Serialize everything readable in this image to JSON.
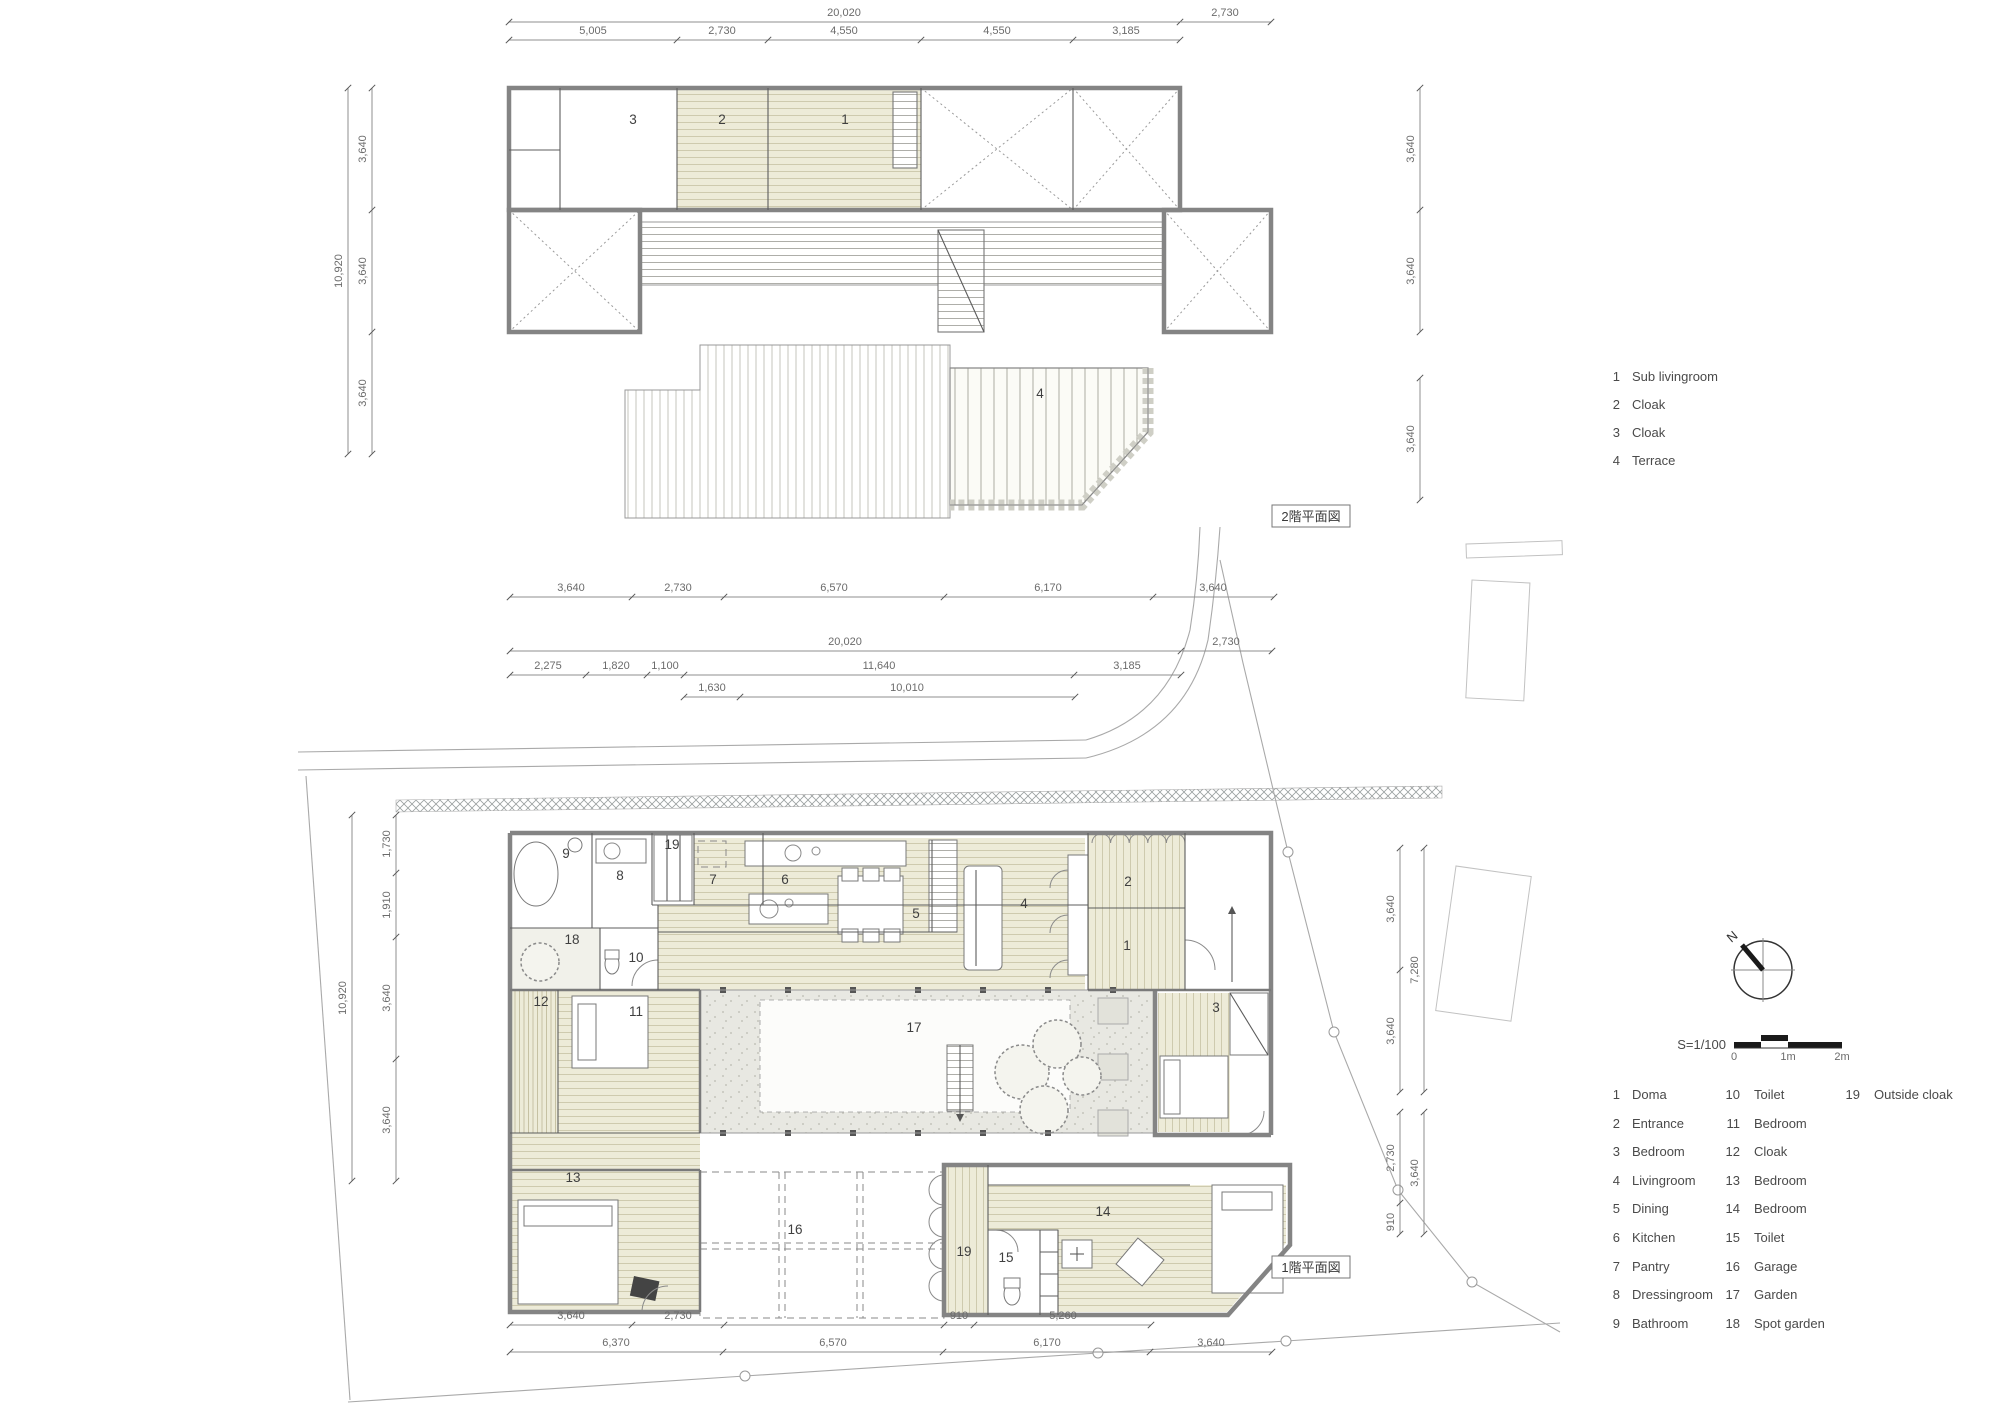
{
  "floor2": {
    "plan_label": "2階平面図",
    "dims": {
      "top_overall": "20,020",
      "top_right": "2,730",
      "top_segments": [
        "5,005",
        "2,730",
        "4,550",
        "4,550",
        "3,185"
      ],
      "left_overall": "10,920",
      "left_segments": [
        "3,640",
        "3,640",
        "3,640"
      ],
      "right_segments": [
        "3,640",
        "3,640"
      ],
      "right_lower": "3,640",
      "bottom_segments": [
        "3,640",
        "2,730",
        "6,570",
        "6,170",
        "3,640"
      ]
    },
    "rooms": [
      {
        "num": "1",
        "name": "Sub livingroom"
      },
      {
        "num": "2",
        "name": "Cloak"
      },
      {
        "num": "3",
        "name": "Cloak"
      },
      {
        "num": "4",
        "name": "Terrace"
      }
    ]
  },
  "floor1": {
    "plan_label": "1階平面図",
    "dims": {
      "top_overall": "20,020",
      "top_right": "2,730",
      "top_row2": [
        "2,275",
        "1,820",
        "1,100",
        "11,640",
        "3,185"
      ],
      "top_row3": [
        "1,630",
        "10,010"
      ],
      "left_overall": "10,920",
      "left_segments": [
        "1,730",
        "1,910",
        "3,640",
        "3,640"
      ],
      "right_upper_overall": "7,280",
      "right_upper_segments": [
        "3,640",
        "3,640"
      ],
      "right_lower_overall": "3,640",
      "right_lower_segments": [
        "2,730",
        "910"
      ],
      "bottom_row1": [
        "3,640",
        "2,730",
        "910",
        "5,260"
      ],
      "bottom_row2": [
        "6,370",
        "6,570",
        "6,170",
        "3,640"
      ]
    },
    "rooms": [
      {
        "num": "1",
        "name": "Doma"
      },
      {
        "num": "2",
        "name": "Entrance"
      },
      {
        "num": "3",
        "name": "Bedroom"
      },
      {
        "num": "4",
        "name": "Livingroom"
      },
      {
        "num": "5",
        "name": "Dining"
      },
      {
        "num": "6",
        "name": "Kitchen"
      },
      {
        "num": "7",
        "name": "Pantry"
      },
      {
        "num": "8",
        "name": "Dressingroom"
      },
      {
        "num": "9",
        "name": "Bathroom"
      },
      {
        "num": "10",
        "name": "Toilet"
      },
      {
        "num": "11",
        "name": "Bedroom"
      },
      {
        "num": "12",
        "name": "Cloak"
      },
      {
        "num": "13",
        "name": "Bedroom"
      },
      {
        "num": "14",
        "name": "Bedroom"
      },
      {
        "num": "15",
        "name": "Toilet"
      },
      {
        "num": "16",
        "name": "Garage"
      },
      {
        "num": "17",
        "name": "Garden"
      },
      {
        "num": "18",
        "name": "Spot garden"
      },
      {
        "num": "19",
        "name": "Outside cloak"
      }
    ]
  },
  "compass": {
    "north_label": "N"
  },
  "scalebar": {
    "scale_label": "S=1/100",
    "tick_labels": [
      "0",
      "1m",
      "2m"
    ]
  },
  "colors": {
    "tatami": "#edebd8",
    "stone": "#d9d9d0",
    "garden_gray": "#e8e8e2",
    "line": "#8a8a8a"
  }
}
